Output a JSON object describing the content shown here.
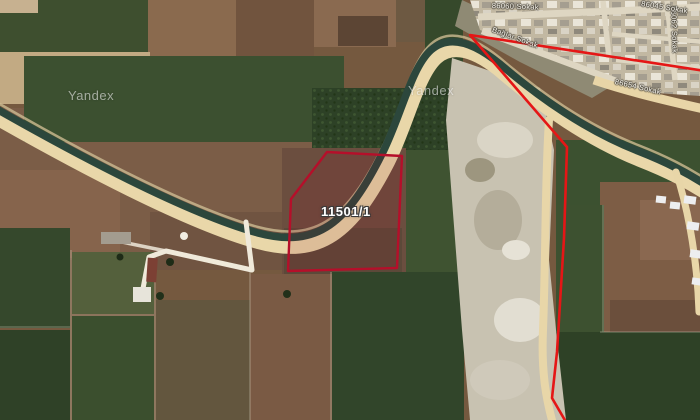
{
  "map": {
    "watermark_left": "Yandex",
    "watermark_right": "Yandex",
    "parcel": {
      "id": "11501/1",
      "fill": "rgba(150,12,38,0.13)"
    },
    "streets": {
      "top": "86060 Sokak",
      "diagonal": "Bağlar Sokak",
      "lower": "86654 Sokak",
      "vertical": "86062 Sokak",
      "top_right": "86045 Sokak"
    },
    "colors": {
      "parcel_outline": "#b50f2a",
      "boundary_line": "#e51616",
      "road": "#e9d7a9",
      "canal": "#2c473c"
    }
  }
}
